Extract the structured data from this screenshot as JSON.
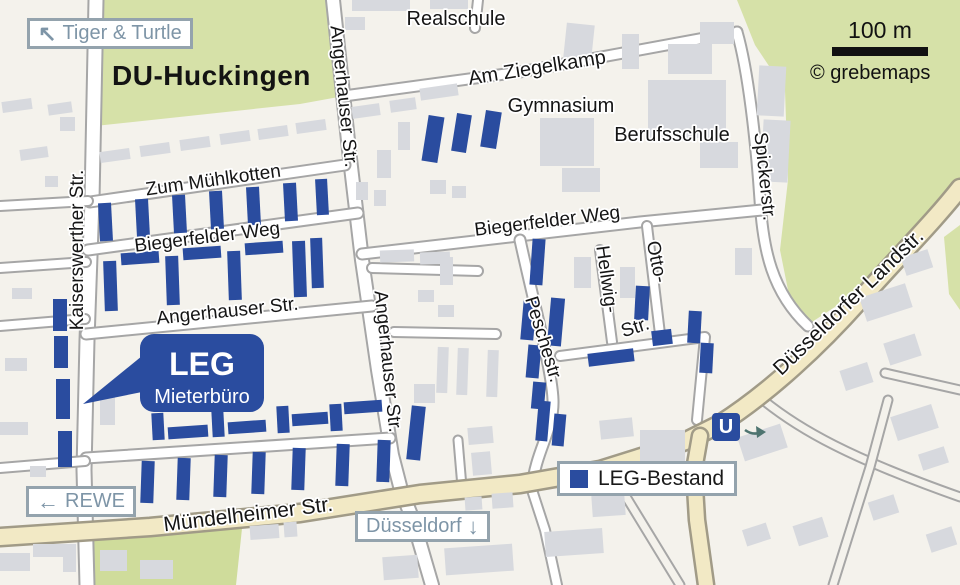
{
  "title": {
    "district": "DU-Huckingen"
  },
  "signs": {
    "tiger_turtle": {
      "arrow": "↖",
      "label": "Tiger & Turtle"
    },
    "rewe": {
      "arrow": "←",
      "label": "REWE"
    },
    "duesseldorf": {
      "label": "Düsseldorf",
      "arrow": "↓"
    },
    "legend": {
      "label": "LEG-Bestand"
    },
    "u_station": {
      "label": "U"
    },
    "scale": {
      "label": "100 m"
    },
    "copyright": {
      "label": "© grebemaps"
    }
  },
  "callout": {
    "line1": "LEG",
    "line2": "Mieterbüro",
    "x": 140,
    "y": 334,
    "w": 124,
    "h": 78,
    "rx": 14,
    "pointer": "83,404 142,356 142,392",
    "text1_x": 202,
    "text1_y": 375,
    "text2_x": 202,
    "text2_y": 403
  },
  "colors": {
    "bg": "#f4f2ec",
    "green": "#d6e1a8",
    "green_field": "#cfdc9b",
    "building": "#d7d9de",
    "road_casing": "#a6a6a6",
    "road_fill": "#ffffff",
    "major_fill": "#f2e9c5",
    "major_casing": "#a19b87",
    "leg_blue": "#2a4c9f",
    "sign_text": "#7e95a7",
    "u_arrow": "#4e7470",
    "label": "#151515"
  },
  "map": {
    "green_areas": [
      {
        "name": "park-north",
        "tone": "park",
        "points": "95,0 333,0 344,96 300,104 95,126"
      },
      {
        "name": "park-east",
        "tone": "park",
        "points": "737,0 960,0 960,185 900,250 850,297 812,322 790,300 780,250 788,180 785,90 755,45"
      },
      {
        "name": "park-east-edge",
        "tone": "park",
        "points": "944,237 960,225 960,310 949,294"
      },
      {
        "name": "field-south",
        "tone": "field",
        "points": "90,532 243,519 236,585 92,585"
      }
    ],
    "roads_plain": [
      {
        "name": "se-road-1",
        "d": "M763,400 C800,430 850,458 960,497",
        "w": 7
      },
      {
        "name": "se-road-2",
        "d": "M888,400 L870,467 L833,585",
        "w": 7
      },
      {
        "name": "se-road-3",
        "d": "M625,495 L680,585",
        "w": 7
      },
      {
        "name": "ne-stub",
        "d": "M885,373 L960,390",
        "w": 7
      }
    ],
    "roads_minor": [
      {
        "name": "kaiserswerther-str",
        "d": "M96,0 L92,200 L87,340 L84,470 L87,585",
        "w": 13
      },
      {
        "name": "angerhauser-str",
        "d": "M333,0 L349,150 L362,260 L378,370 L392,455 L401,490 L413,520 L432,585",
        "w": 12
      },
      {
        "name": "zum-muehlkotten",
        "d": "M90,202 L345,165",
        "w": 9
      },
      {
        "name": "biegerfelder-weg-west",
        "d": "M88,250 L358,213",
        "w": 9
      },
      {
        "name": "angerhauser-str-west",
        "d": "M86,334 L372,306",
        "w": 9
      },
      {
        "name": "quarter-street",
        "d": "M86,458 L390,438",
        "w": 9
      },
      {
        "name": "west-stub-1",
        "d": "M0,206 L88,201",
        "w": 8
      },
      {
        "name": "west-stub-2",
        "d": "M0,268 L86,262",
        "w": 8
      },
      {
        "name": "west-stub-3",
        "d": "M0,326 L85,319",
        "w": 8
      },
      {
        "name": "west-stub-4",
        "d": "M0,468 L85,461",
        "w": 8
      },
      {
        "name": "am-ziegelkamp",
        "d": "M344,96 L520,72 L737,32",
        "w": 9
      },
      {
        "name": "school-stub",
        "d": "M478,0 L475,28",
        "w": 8
      },
      {
        "name": "spickerstr",
        "d": "M737,32 C748,70 756,140 760,200 C763,250 772,292 808,326",
        "w": 9
      },
      {
        "name": "biegerfelder-weg-east",
        "d": "M362,254 L640,222 L762,210",
        "w": 9
      },
      {
        "name": "hellwigstr",
        "d": "M600,250 L612,342",
        "w": 8
      },
      {
        "name": "ottostr",
        "d": "M647,226 L660,334",
        "w": 8
      },
      {
        "name": "str-connector",
        "d": "M560,356 L705,337 L697,420",
        "w": 8
      },
      {
        "name": "peschestr",
        "d": "M520,240 C533,300 552,370 553,400 C554,430 536,450 532,487",
        "w": 9
      },
      {
        "name": "peschestr-south",
        "d": "M532,490 L545,530 L557,585",
        "w": 8
      },
      {
        "name": "culdesac-1",
        "d": "M372,268 L478,271",
        "w": 8
      },
      {
        "name": "culdesac-2",
        "d": "M394,332 L496,334",
        "w": 8
      },
      {
        "name": "access-street",
        "d": "M458,440 L462,487",
        "w": 7
      }
    ],
    "roads_major": [
      {
        "name": "muendelheimer-landstr",
        "d": "M0,537 L150,527 L300,513 L420,494 L520,484 L600,470 L648,455 L688,440 L720,424 C770,392 820,345 860,300 C900,255 935,220 960,188",
        "w": 16
      },
      {
        "name": "landstr-south-branch",
        "d": "M700,436 L694,470 L697,520 L706,585",
        "w": 14
      }
    ],
    "gray_buildings": [
      [
        2,
        100,
        30,
        11,
        -8
      ],
      [
        48,
        103,
        24,
        11,
        -8
      ],
      [
        60,
        117,
        15,
        14,
        0
      ],
      [
        20,
        148,
        28,
        11,
        -8
      ],
      [
        45,
        176,
        13,
        11,
        0
      ],
      [
        12,
        288,
        20,
        11,
        0
      ],
      [
        5,
        358,
        22,
        13,
        0
      ],
      [
        0,
        422,
        28,
        13,
        0
      ],
      [
        30,
        466,
        16,
        11,
        0
      ],
      [
        0,
        553,
        30,
        18,
        0
      ],
      [
        33,
        544,
        34,
        13,
        0
      ],
      [
        63,
        544,
        13,
        28,
        0
      ],
      [
        100,
        550,
        27,
        21,
        0
      ],
      [
        140,
        560,
        33,
        19,
        0
      ],
      [
        100,
        150,
        30,
        11,
        -8
      ],
      [
        140,
        144,
        30,
        11,
        -8
      ],
      [
        180,
        138,
        30,
        11,
        -8
      ],
      [
        220,
        132,
        30,
        11,
        -8
      ],
      [
        258,
        127,
        30,
        11,
        -8
      ],
      [
        296,
        121,
        30,
        11,
        -8
      ],
      [
        345,
        17,
        20,
        13,
        0
      ],
      [
        352,
        0,
        58,
        11,
        0
      ],
      [
        430,
        0,
        38,
        9,
        0
      ],
      [
        352,
        105,
        28,
        12,
        -8
      ],
      [
        390,
        99,
        26,
        12,
        -8
      ],
      [
        420,
        86,
        38,
        12,
        -8
      ],
      [
        398,
        122,
        12,
        28,
        0
      ],
      [
        377,
        150,
        14,
        28,
        0
      ],
      [
        356,
        182,
        12,
        18,
        0
      ],
      [
        374,
        190,
        12,
        16,
        0
      ],
      [
        430,
        180,
        16,
        14,
        0
      ],
      [
        452,
        186,
        14,
        12,
        0
      ],
      [
        565,
        24,
        28,
        35,
        6
      ],
      [
        622,
        34,
        17,
        35,
        0
      ],
      [
        700,
        22,
        34,
        22,
        0
      ],
      [
        540,
        118,
        54,
        48,
        0
      ],
      [
        562,
        168,
        38,
        24,
        0
      ],
      [
        648,
        80,
        78,
        58,
        0
      ],
      [
        668,
        44,
        44,
        30,
        0
      ],
      [
        700,
        142,
        38,
        26,
        0
      ],
      [
        758,
        66,
        27,
        50,
        3
      ],
      [
        762,
        120,
        27,
        62,
        3
      ],
      [
        735,
        248,
        17,
        27,
        0
      ],
      [
        380,
        250,
        34,
        12,
        -2
      ],
      [
        420,
        252,
        30,
        12,
        -2
      ],
      [
        440,
        257,
        13,
        28,
        0
      ],
      [
        418,
        290,
        16,
        12,
        0
      ],
      [
        438,
        305,
        16,
        12,
        0
      ],
      [
        437,
        347,
        11,
        46,
        2
      ],
      [
        457,
        348,
        11,
        47,
        2
      ],
      [
        487,
        350,
        11,
        47,
        2
      ],
      [
        574,
        257,
        17,
        31,
        0
      ],
      [
        620,
        267,
        15,
        31,
        0
      ],
      [
        100,
        396,
        15,
        29,
        0
      ],
      [
        414,
        384,
        21,
        19,
        0
      ],
      [
        468,
        427,
        25,
        17,
        -5
      ],
      [
        472,
        452,
        19,
        23,
        -5
      ],
      [
        862,
        290,
        48,
        25,
        -18
      ],
      [
        886,
        338,
        33,
        23,
        -18
      ],
      [
        842,
        366,
        29,
        21,
        -18
      ],
      [
        903,
        253,
        28,
        19,
        -18
      ],
      [
        640,
        430,
        45,
        33,
        0
      ],
      [
        600,
        419,
        33,
        19,
        -6
      ],
      [
        740,
        430,
        45,
        25,
        -18
      ],
      [
        893,
        410,
        43,
        25,
        -18
      ],
      [
        920,
        450,
        27,
        17,
        -18
      ],
      [
        795,
        521,
        31,
        21,
        -18
      ],
      [
        870,
        498,
        27,
        19,
        -18
      ],
      [
        744,
        526,
        25,
        17,
        -18
      ],
      [
        928,
        530,
        27,
        19,
        -18
      ],
      [
        545,
        530,
        58,
        25,
        -4
      ],
      [
        592,
        495,
        33,
        21,
        -4
      ],
      [
        445,
        546,
        68,
        27,
        -4
      ],
      [
        383,
        556,
        35,
        23,
        -4
      ],
      [
        250,
        525,
        29,
        14,
        -4
      ],
      [
        284,
        522,
        13,
        15,
        -4
      ],
      [
        465,
        497,
        17,
        13,
        -4
      ],
      [
        492,
        493,
        21,
        15,
        -4
      ]
    ],
    "blue_buildings": [
      [
        99,
        203,
        13,
        38,
        -3
      ],
      [
        136,
        199,
        13,
        38,
        -3
      ],
      [
        173,
        195,
        13,
        38,
        -3
      ],
      [
        210,
        191,
        13,
        38,
        -3
      ],
      [
        247,
        187,
        13,
        38,
        -3
      ],
      [
        284,
        183,
        13,
        38,
        -3
      ],
      [
        316,
        179,
        12,
        36,
        -3
      ],
      [
        104,
        261,
        13,
        50,
        -2
      ],
      [
        121,
        252,
        38,
        12,
        -4
      ],
      [
        166,
        256,
        13,
        49,
        -2
      ],
      [
        183,
        247,
        38,
        12,
        -4
      ],
      [
        228,
        251,
        13,
        49,
        -2
      ],
      [
        245,
        242,
        38,
        12,
        -4
      ],
      [
        293,
        241,
        13,
        56,
        -2
      ],
      [
        311,
        238,
        12,
        50,
        -2
      ],
      [
        53,
        299,
        14,
        32,
        0
      ],
      [
        54,
        336,
        14,
        32,
        0
      ],
      [
        56,
        379,
        14,
        40,
        0
      ],
      [
        58,
        431,
        14,
        36,
        0
      ],
      [
        152,
        413,
        12,
        27,
        -3
      ],
      [
        168,
        426,
        40,
        12,
        -4
      ],
      [
        212,
        410,
        12,
        27,
        -3
      ],
      [
        228,
        421,
        38,
        12,
        -4
      ],
      [
        277,
        406,
        12,
        27,
        -3
      ],
      [
        292,
        413,
        36,
        12,
        -4
      ],
      [
        330,
        404,
        12,
        27,
        -3
      ],
      [
        344,
        401,
        38,
        12,
        -4
      ],
      [
        141,
        461,
        13,
        42,
        2
      ],
      [
        177,
        458,
        13,
        42,
        2
      ],
      [
        214,
        455,
        13,
        42,
        2
      ],
      [
        252,
        452,
        13,
        42,
        2
      ],
      [
        292,
        448,
        13,
        42,
        2
      ],
      [
        336,
        444,
        13,
        42,
        2
      ],
      [
        377,
        440,
        13,
        42,
        2
      ],
      [
        409,
        406,
        14,
        54,
        6
      ],
      [
        537,
        401,
        12,
        40,
        5
      ],
      [
        553,
        414,
        12,
        32,
        5
      ],
      [
        425,
        116,
        16,
        46,
        9
      ],
      [
        454,
        114,
        15,
        38,
        9
      ],
      [
        483,
        111,
        16,
        37,
        9
      ],
      [
        531,
        239,
        13,
        46,
        4
      ],
      [
        522,
        300,
        13,
        40,
        5
      ],
      [
        549,
        298,
        14,
        48,
        5
      ],
      [
        527,
        345,
        13,
        33,
        5
      ],
      [
        532,
        382,
        13,
        27,
        5
      ],
      [
        635,
        286,
        14,
        34,
        3
      ],
      [
        588,
        351,
        46,
        13,
        -7
      ],
      [
        652,
        330,
        20,
        15,
        -7
      ],
      [
        688,
        311,
        13,
        32,
        3
      ],
      [
        700,
        343,
        13,
        30,
        3
      ]
    ],
    "street_labels": [
      {
        "text": "Zum Mühlkotten",
        "x": 214,
        "y": 186,
        "rot": -8,
        "size": 19
      },
      {
        "text": "Biegerfelder Weg",
        "x": 208,
        "y": 243,
        "rot": -7,
        "size": 19
      },
      {
        "text": "Angerhauser Str.",
        "x": 228,
        "y": 317,
        "rot": -6,
        "size": 19
      },
      {
        "text": "Kaiserswerther Str.",
        "x": 83,
        "y": 250,
        "rot": -90,
        "size": 19
      },
      {
        "text": "Angerhauser Str.",
        "x": 338,
        "y": 97,
        "rot": 84,
        "size": 19
      },
      {
        "text": "Angerhauser Str.",
        "x": 382,
        "y": 362,
        "rot": 84,
        "size": 19
      },
      {
        "text": "Am Ziegelkamp",
        "x": 538,
        "y": 74,
        "rot": -9,
        "size": 20
      },
      {
        "text": "Realschule",
        "x": 456,
        "y": 25,
        "rot": 0,
        "size": 20
      },
      {
        "text": "Gymnasium",
        "x": 561,
        "y": 112,
        "rot": 0,
        "size": 20
      },
      {
        "text": "Berufsschule",
        "x": 672,
        "y": 141,
        "rot": 0,
        "size": 20
      },
      {
        "text": "Biegerfelder Weg",
        "x": 548,
        "y": 227,
        "rot": -7,
        "size": 19
      },
      {
        "text": "Hellwig-",
        "x": 601,
        "y": 280,
        "rot": 82,
        "size": 19
      },
      {
        "text": "Otto-",
        "x": 651,
        "y": 263,
        "rot": 78,
        "size": 19
      },
      {
        "text": "Str.",
        "x": 637,
        "y": 333,
        "rot": -18,
        "size": 19
      },
      {
        "text": "Peschestr.",
        "x": 538,
        "y": 341,
        "rot": 73,
        "size": 19
      },
      {
        "text": "Spickerstr.",
        "x": 759,
        "y": 177,
        "rot": 84,
        "size": 19
      },
      {
        "text": "Mündelheimer Str.",
        "x": 249,
        "y": 521,
        "rot": -7,
        "size": 21
      },
      {
        "text": "Düsseldorfer Landstr.",
        "x": 853,
        "y": 307,
        "rot": -44,
        "size": 21
      }
    ]
  }
}
